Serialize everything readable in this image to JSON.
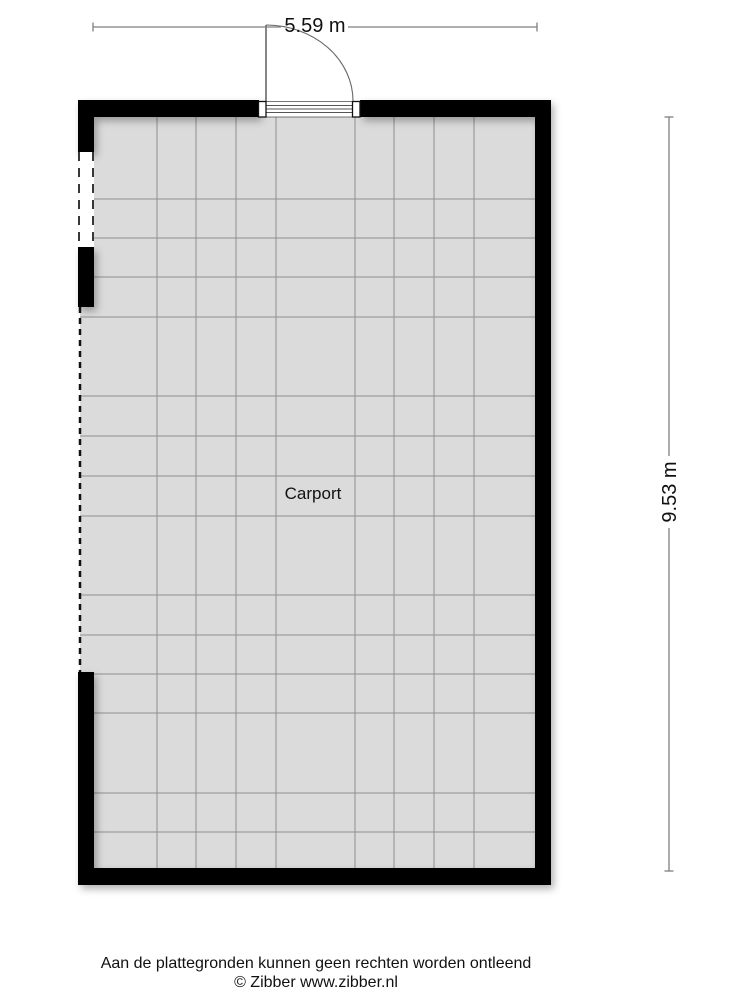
{
  "plan": {
    "room_label": "Carport",
    "width_dimension": "5.59 m",
    "height_dimension": "9.53 m"
  },
  "footer": {
    "disclaimer": "Aan de plattegronden kunnen geen rechten worden ontleend",
    "copyright": "© Zibber www.zibber.nl"
  },
  "colors": {
    "wall": "#000000",
    "floor": "#dbdbdb",
    "grid_line": "#8f8f8f",
    "dimension_line": "#7f7f7f",
    "text": "#111111"
  }
}
